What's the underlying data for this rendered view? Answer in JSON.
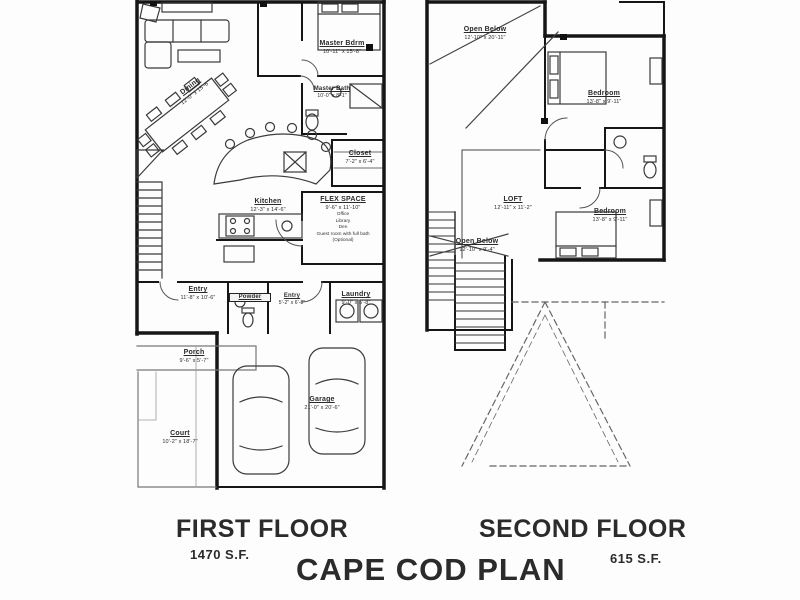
{
  "titles": {
    "plan_name": "CAPE COD PLAN",
    "first_floor": {
      "label": "FIRST FLOOR",
      "area": "1470 S.F."
    },
    "second_floor": {
      "label": "SECOND FLOOR",
      "area": "615 S.F."
    }
  },
  "ff": {
    "master_bdrm": {
      "name": "Master Bdrm",
      "dims": "10'-11\" x 15'-8\""
    },
    "master_bath": {
      "name": "Master Bath",
      "dims": "10'-0\" x 8'-1\""
    },
    "closet": {
      "name": "Closet",
      "dims": "7'-2\" x 6'-4\""
    },
    "dining": {
      "name": "Dining",
      "dims": "12'-0\" x 15'-6\""
    },
    "kitchen": {
      "name": "Kitchen",
      "dims": "12'-3\" x 14'-6\""
    },
    "flex": {
      "name": "FLEX SPACE",
      "dims": "9'-6\" x 11'-10\"",
      "options": [
        "Office",
        "Library",
        "Den",
        "Guest room with full bath",
        "(Optional)"
      ]
    },
    "entry1": {
      "name": "Entry",
      "dims": "11'-8\" x 10'-6\""
    },
    "powder": {
      "name": "Powder"
    },
    "entry2": {
      "name": "Entry",
      "dims": "5'-2\" x 6'-8\""
    },
    "laundry": {
      "name": "Laundry",
      "dims": "9'-0\" x 5'-8\""
    },
    "porch": {
      "name": "Porch",
      "dims": "9'-6\" x 5'-7\""
    },
    "court": {
      "name": "Court",
      "dims": "10'-2\" x 18'-7\""
    },
    "garage": {
      "name": "Garage",
      "dims": "21'-0\" x 20'-6\""
    }
  },
  "sf": {
    "open_below_top": {
      "name": "Open Below",
      "dims": "12'-10\" x 20'-11\""
    },
    "bedroom_top": {
      "name": "Bedroom",
      "dims": "13'-8\" x 9'-11\""
    },
    "loft": {
      "name": "LOFT",
      "dims": "12'-11\" x 11'-2\""
    },
    "open_below_mid": {
      "name": "Open Below",
      "dims": "12'-10\" x 9'-4\""
    },
    "bedroom_bottom": {
      "name": "Bedroom",
      "dims": "13'-8\" x 9'-11\""
    }
  }
}
